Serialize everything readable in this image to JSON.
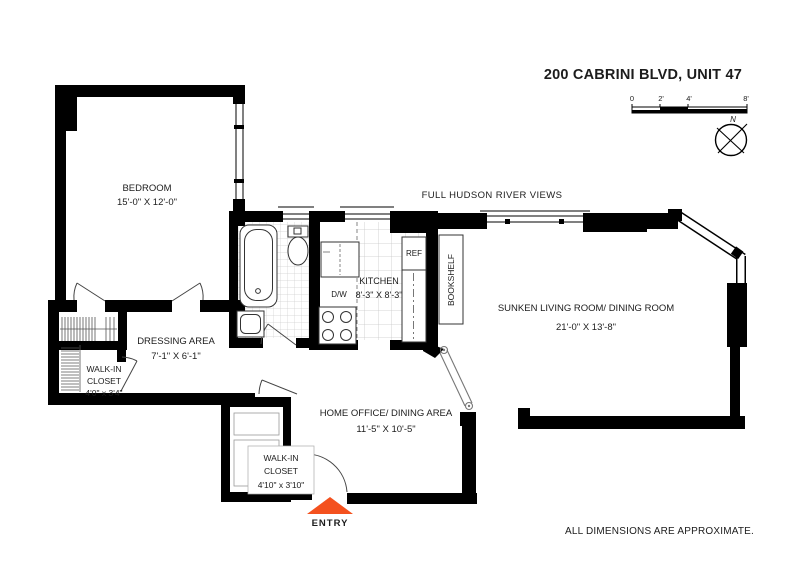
{
  "header": {
    "title": "200 CABRINI BLVD, UNIT 47"
  },
  "scale_bar": {
    "labels": [
      "0",
      "2'",
      "4'",
      "8'"
    ]
  },
  "compass": {
    "north_label": "N"
  },
  "annotations": {
    "view_note": "FULL HUDSON RIVER VIEWS",
    "entry_label": "ENTRY",
    "disclaimer": "ALL DIMENSIONS ARE APPROXIMATE."
  },
  "rooms": {
    "bedroom": {
      "name": "BEDROOM",
      "dimensions": "15'-0\" X 12'-0\""
    },
    "dressing_area": {
      "name": "DRESSING AREA",
      "dimensions": "7'-1\" X 6'-1\""
    },
    "walk_in_closet_left": {
      "name_line1": "WALK-IN",
      "name_line2": "CLOSET",
      "dimensions": "4'0\" x 3'4\""
    },
    "kitchen": {
      "name": "KITCHEN",
      "dimensions": "8'-3\" X 8'-3\""
    },
    "sunken_living_dining": {
      "name": "SUNKEN LIVING ROOM/ DINING ROOM",
      "dimensions": "21'-0\" X 13'-8\""
    },
    "home_office_dining": {
      "name": "HOME OFFICE/ DINING AREA",
      "dimensions": "11'-5\" X 10'-5\""
    },
    "walk_in_closet_entry": {
      "name_line1": "WALK-IN",
      "name_line2": "CLOSET",
      "dimensions": "4'10\" x 3'10\""
    }
  },
  "fixtures": {
    "refrigerator": "REF",
    "dishwasher": "D/W",
    "bookshelf": "BOOKSHELF"
  },
  "colors": {
    "wall": "#000000",
    "entry_accent": "#F4511E",
    "disclaimer_gray": "#9C9C9C"
  }
}
